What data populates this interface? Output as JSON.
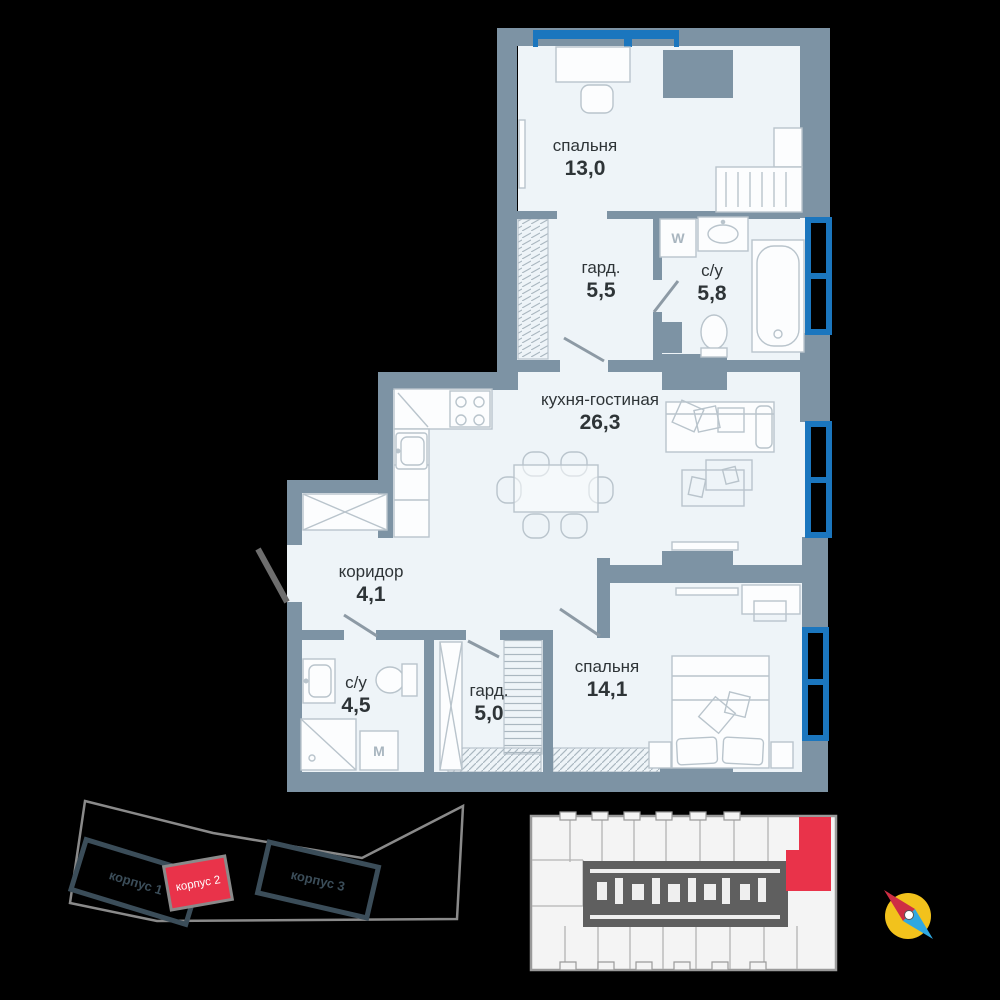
{
  "floor_plan": {
    "rooms": [
      {
        "id": "bedroom-top",
        "name": "спальня",
        "area": "13,0"
      },
      {
        "id": "wardrobe-top",
        "name": "гард.",
        "area": "5,5"
      },
      {
        "id": "bathroom-top",
        "name": "с/у",
        "area": "5,8"
      },
      {
        "id": "kitchen-living",
        "name": "кухня-гостиная",
        "area": "26,3"
      },
      {
        "id": "corridor",
        "name": "коридор",
        "area": "4,1"
      },
      {
        "id": "bathroom-bottom",
        "name": "с/у",
        "area": "4,5"
      },
      {
        "id": "wardrobe-bottom",
        "name": "гард.",
        "area": "5,0"
      },
      {
        "id": "bedroom-bottom",
        "name": "спальня",
        "area": "14,1"
      }
    ],
    "appliances": {
      "washer_top_label": "W",
      "washer_bottom_label": "M"
    }
  },
  "site_plan": {
    "buildings": [
      {
        "label": "корпус 1",
        "highlighted": false
      },
      {
        "label": "корпус 2",
        "highlighted": true
      },
      {
        "label": "корпус 3",
        "highlighted": false
      }
    ]
  },
  "floor_overview": {
    "selected_unit": "highlighted-red"
  },
  "colors": {
    "wall": "#7d93a4",
    "room_fill": "#eef4f8",
    "window_blue": "#1b76be",
    "accent_red": "#e9334a",
    "furniture_line": "#b9c4cc",
    "core_dark": "#5f5f5f",
    "compass_yellow": "#f2c21c"
  }
}
